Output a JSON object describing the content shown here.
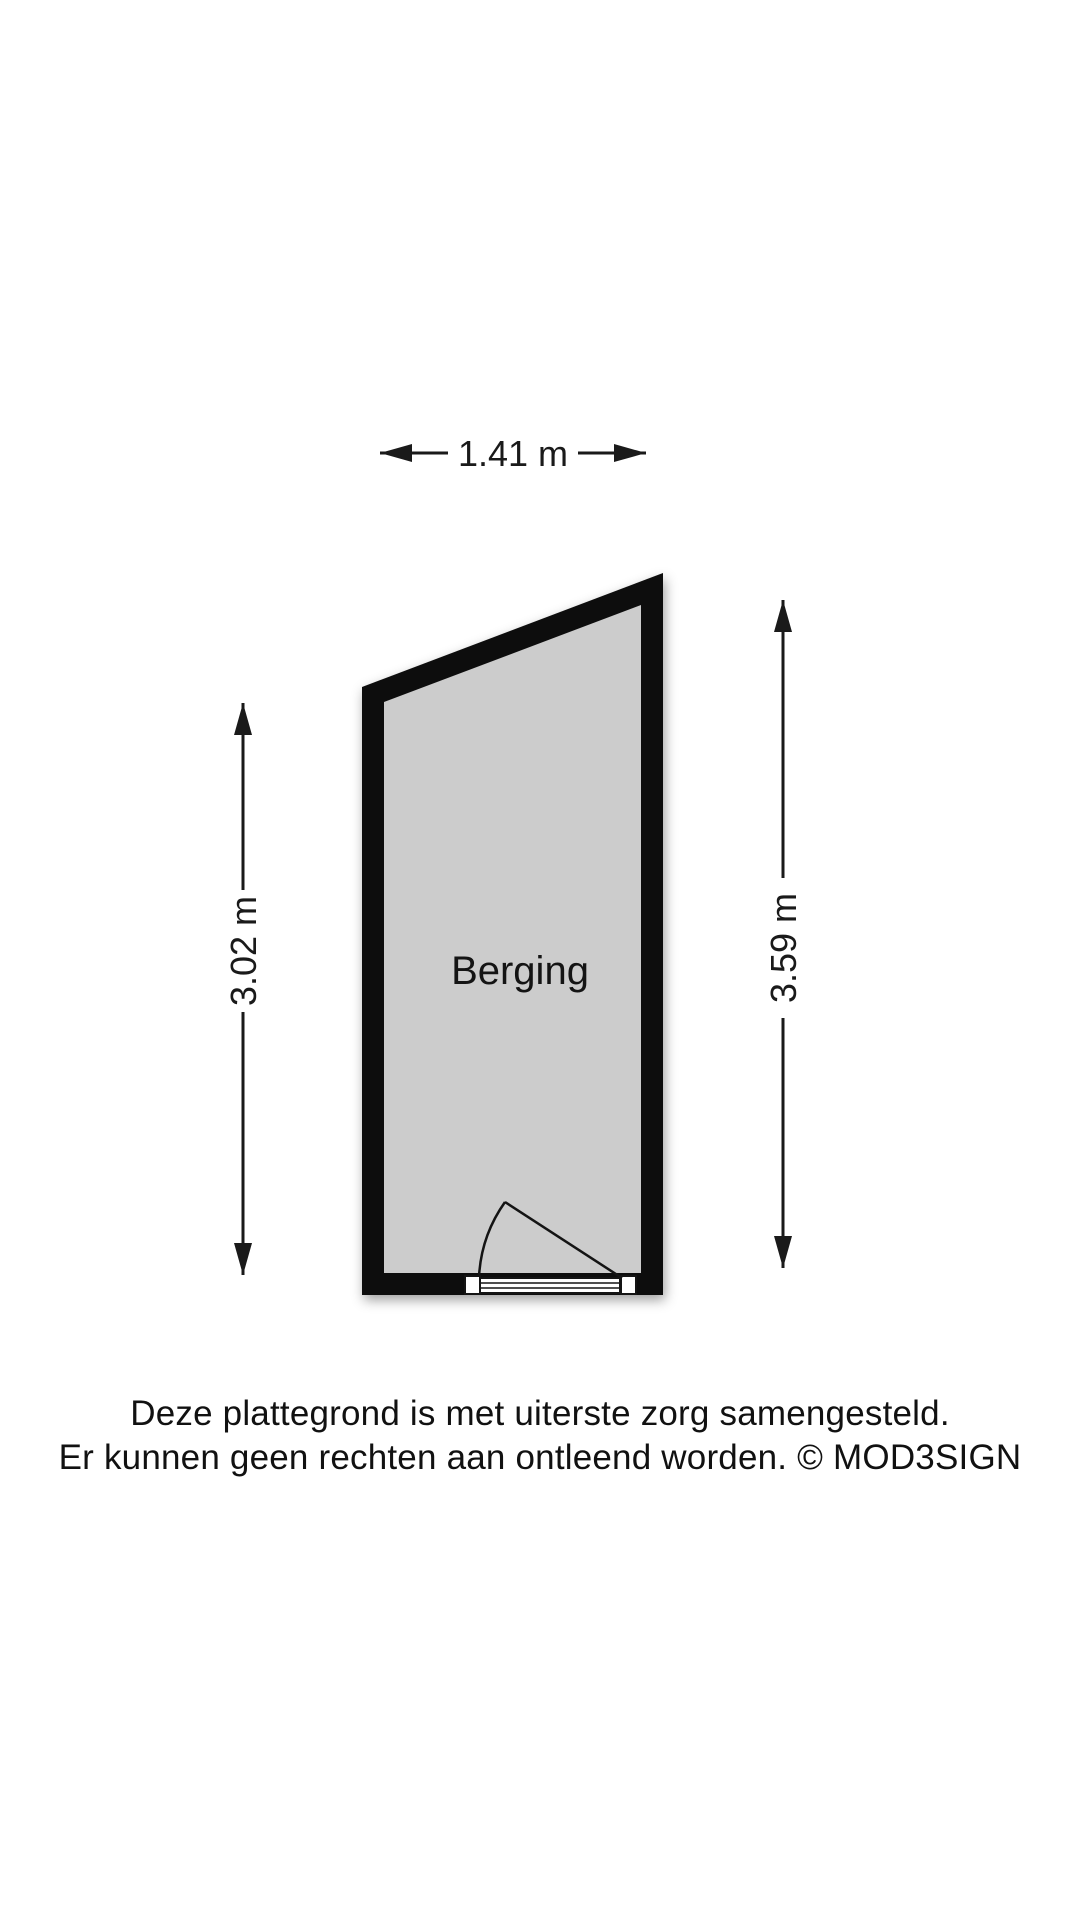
{
  "floorplan": {
    "room_label": "Berging",
    "dimensions": {
      "top": "1.41 m",
      "left": "3.02 m",
      "right": "3.59 m"
    }
  },
  "disclaimer": {
    "line1": "Deze plattegrond is met uiterste zorg samengesteld.",
    "line2": "Er kunnen geen rechten aan ontleend worden. © MOD3SIGN"
  },
  "colors": {
    "wall": "#0d0d0d",
    "floor": "#cccccc",
    "door": "#ffffff",
    "line": "#1a1a1a",
    "background": "#ffffff"
  }
}
